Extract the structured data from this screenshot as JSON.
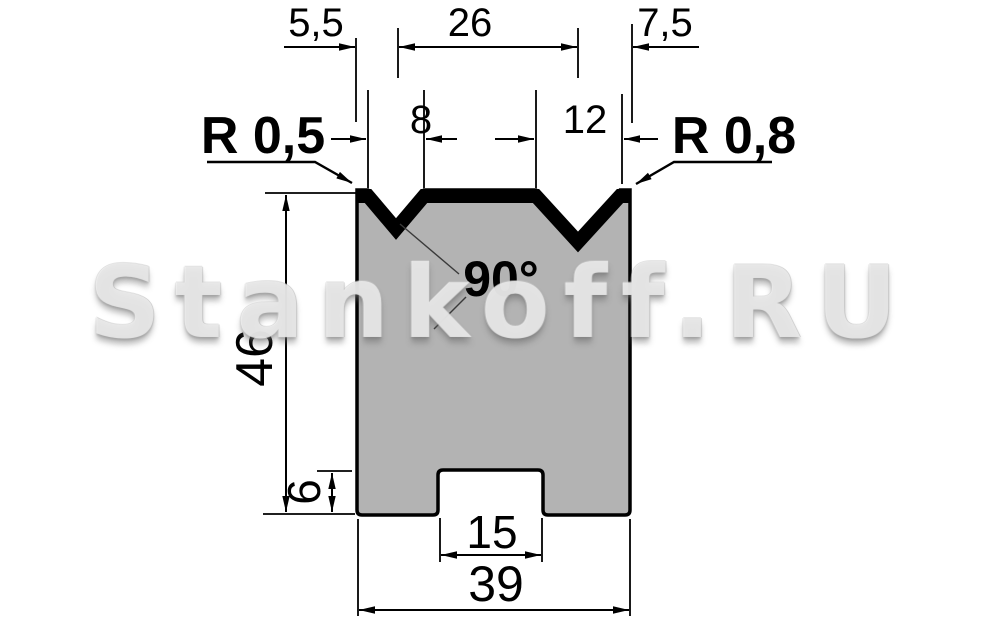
{
  "watermark": {
    "text": "Stankoff.RU"
  },
  "labels": {
    "offset_left": "5,5",
    "vee_centers": "26",
    "offset_right": "7,5",
    "v1_width": "8",
    "v2_width": "12",
    "radius_left": "R 0,5",
    "radius_right": "R 0,8",
    "angle": "90°",
    "height": "46",
    "shoulder": "6",
    "slot": "15",
    "width": "39"
  },
  "colors": {
    "body_fill": "#b3b3b3",
    "line": "#000000",
    "background": "#ffffff"
  }
}
